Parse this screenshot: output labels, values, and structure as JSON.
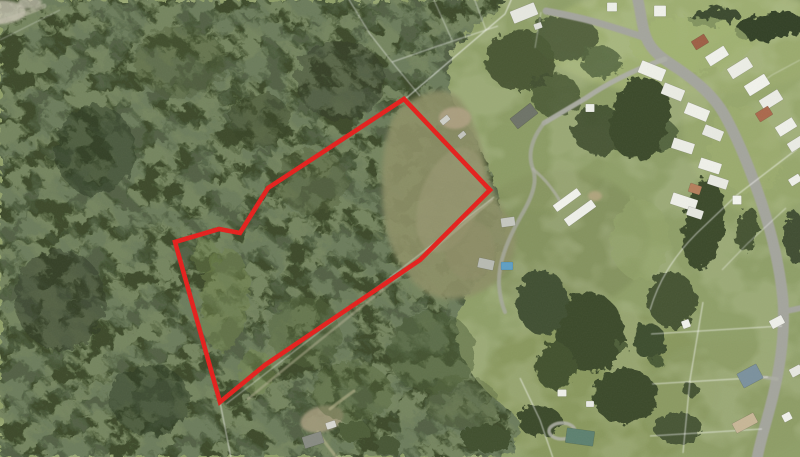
{
  "map": {
    "kind": "aerial-photo-with-parcel-overlay",
    "canvas": {
      "width": 800,
      "height": 457
    },
    "palette": {
      "field_base": "#8f9f68",
      "forest_base": "#3c4a2a",
      "forest_light_blotch": "#6b8449",
      "forest_dark_blotch": "#212e19",
      "clearing": "#8d8f66",
      "road": "#a4a59d",
      "cadastral_line": "#ffffff",
      "boundary_red": "#e51f1c"
    },
    "boundary_overlay": {
      "color": "#e51f1c",
      "stroke_width": 4.6,
      "closed": true,
      "points": [
        [
          404,
          99
        ],
        [
          490,
          190
        ],
        [
          420,
          260
        ],
        [
          265,
          365
        ],
        [
          220,
          402
        ],
        [
          175,
          242
        ],
        [
          219,
          229
        ],
        [
          240,
          233
        ],
        [
          268,
          188
        ]
      ]
    },
    "forest": {
      "clip": "M 0,0 L 505,0 C 496,16 470,30 454,50 C 446,66 446,86 453,100 C 463,120 479,143 489,168 C 495,185 500,206 504,224 C 507,247 490,268 471,290 C 457,307 452,326 459,349 C 469,376 489,397 513,413 C 524,425 518,443 504,457 L 0,457 Z",
      "base_fill": "#3c4a2a"
    },
    "clearing": {
      "path": "M 405,104 C 430,88 448,86 460,100 C 472,115 480,140 487,168 C 492,186 497,204 510,220 C 520,237 516,258 502,275 C 488,293 462,302 440,298 C 418,294 398,268 389,240 C 381,214 380,170 386,140 C 390,122 396,110 405,104 Z",
      "fill": "#8d8f66",
      "opacity": 0.9
    },
    "field_patches": [
      [
        690,
        40,
        150,
        55,
        0,
        "#a2b273",
        0.8
      ],
      [
        762,
        120,
        80,
        95,
        0,
        "#9aa96d",
        0.7
      ],
      [
        560,
        240,
        90,
        70,
        0,
        "#7e8c59",
        0.6
      ],
      [
        600,
        390,
        120,
        80,
        0,
        "#849158",
        0.55
      ],
      [
        730,
        400,
        90,
        60,
        0,
        "#8d9d66",
        0.6
      ],
      [
        545,
        150,
        60,
        60,
        0,
        "#8a9a62",
        0.6
      ]
    ],
    "dirt_patches": [
      [
        455,
        118,
        16,
        11,
        0,
        "#b0a184",
        0.85
      ],
      [
        595,
        196,
        7,
        5,
        0,
        "#b3a580",
        0.9
      ],
      [
        322,
        419,
        22,
        13,
        -15,
        "#a29a7c",
        0.9
      ],
      [
        0,
        12,
        26,
        12,
        0,
        "#c6c2b2",
        0.8
      ],
      [
        30,
        3,
        12,
        6,
        0,
        "#cac6b6",
        0.7
      ],
      [
        450,
        200,
        30,
        55,
        20,
        "#9a9873",
        0.6
      ],
      [
        470,
        250,
        25,
        30,
        0,
        "#8f8e68",
        0.6
      ]
    ],
    "vegetation": [
      [
        95,
        150,
        40,
        45,
        0,
        "#2c3722",
        0.5
      ],
      [
        60,
        300,
        45,
        50,
        0,
        "#2b3621",
        0.45
      ],
      [
        150,
        400,
        40,
        35,
        0,
        "#2e3923",
        0.5
      ],
      [
        340,
        80,
        45,
        40,
        0,
        "#2f3a24",
        0.4
      ],
      [
        260,
        120,
        30,
        28,
        0,
        "#313e26",
        0.45
      ],
      [
        225,
        300,
        24,
        52,
        4,
        "#6f8349",
        0.5
      ],
      [
        256,
        372,
        18,
        22,
        0,
        "#75894e",
        0.45
      ],
      [
        205,
        256,
        13,
        18,
        0,
        "#6d8148",
        0.4
      ],
      [
        305,
        332,
        36,
        36,
        0,
        "#55663c",
        0.45
      ],
      [
        352,
        392,
        40,
        30,
        0,
        "#51613a",
        0.4
      ],
      [
        432,
        352,
        44,
        40,
        0,
        "#4b5b35",
        0.5
      ],
      [
        462,
        402,
        36,
        26,
        0,
        "#52633c",
        0.4
      ],
      [
        312,
        182,
        36,
        32,
        0,
        "#4d5d38",
        0.4
      ],
      [
        180,
        62,
        46,
        36,
        0,
        "#495936",
        0.35
      ],
      [
        520,
        60,
        35,
        30,
        0,
        "#3c4a2c",
        0.85
      ],
      [
        555,
        95,
        25,
        22,
        0,
        "#42512f",
        0.8
      ],
      [
        600,
        130,
        28,
        25,
        0,
        "#3b492b",
        0.85
      ],
      [
        660,
        135,
        18,
        16,
        0,
        "#465534",
        0.8
      ],
      [
        640,
        118,
        30,
        42,
        12,
        "#3a482b",
        1
      ],
      [
        703,
        224,
        20,
        46,
        8,
        "#3a482b",
        1
      ],
      [
        672,
        300,
        24,
        28,
        0,
        "#445332",
        1
      ],
      [
        590,
        332,
        34,
        40,
        -10,
        "#3a482b",
        1
      ],
      [
        542,
        302,
        26,
        32,
        0,
        "#405031",
        1
      ],
      [
        625,
        396,
        32,
        28,
        0,
        "#3a482b",
        1
      ],
      [
        678,
        428,
        24,
        16,
        0,
        "#465534",
        1
      ],
      [
        555,
        366,
        20,
        24,
        0,
        "#42512f",
        1
      ],
      [
        650,
        342,
        16,
        18,
        0,
        "#3e4d2e",
        1
      ],
      [
        565,
        37,
        32,
        24,
        0,
        "#4a5a36",
        0.9
      ],
      [
        601,
        62,
        20,
        16,
        0,
        "#53643e",
        0.85
      ],
      [
        770,
        27,
        36,
        13,
        -8,
        "#334028",
        1
      ],
      [
        714,
        17,
        26,
        9,
        -6,
        "#3a4a2e",
        1
      ],
      [
        748,
        230,
        11,
        22,
        10,
        "#445332",
        1
      ],
      [
        795,
        238,
        10,
        26,
        0,
        "#3f4e30",
        1
      ],
      [
        540,
        421,
        22,
        15,
        0,
        "#3a482b",
        1
      ],
      [
        487,
        438,
        26,
        13,
        0,
        "#40502f",
        1
      ],
      [
        354,
        431,
        15,
        11,
        0,
        "#4d5d38",
        1
      ],
      [
        388,
        446,
        13,
        9,
        0,
        "#475736",
        1
      ],
      [
        692,
        391,
        8,
        7,
        0,
        "#445332",
        1
      ],
      [
        658,
        362,
        7,
        6,
        0,
        "#4a5a36",
        1
      ],
      [
        622,
        347,
        6,
        6,
        0,
        "#4d5d38",
        1
      ],
      [
        690,
        45,
        60,
        28,
        0,
        "#a3b374",
        0.7
      ],
      [
        745,
        150,
        35,
        45,
        -20,
        "#9fae70",
        0.6
      ],
      [
        640,
        240,
        30,
        40,
        0,
        "#95a56b",
        0.6
      ]
    ],
    "roads": [
      {
        "d": "M 637,-4 C 641,12 642,28 646,37 C 651,51 663,59 677,68 C 696,81 713,95 724,114 C 737,137 749,166 761,201 C 772,234 780,267 783,301 C 785,331 781,363 773,396 C 767,421 760,441 757,459",
        "s": "#a4a59d",
        "w": 11,
        "o": 1
      },
      {
        "d": "M 646,38 C 625,31 604,24 584,19 C 571,16 557,13 546,11",
        "s": "#a4a59d",
        "w": 7,
        "o": 1
      },
      {
        "d": "M 665,59 C 636,69 608,83 586,98 C 569,108 554,117 544,123",
        "s": "#adaea5",
        "w": 5,
        "o": 0.95
      },
      {
        "d": "M 544,123 C 530,141 528,156 533,169 C 538,183 531,199 521,216 C 507,241 498,263 499,285 C 500,297 502,305 505,312",
        "s": "#a8a99f",
        "w": 4,
        "o": 0.8
      },
      {
        "d": "M 533,169 C 546,180 556,193 562,205",
        "s": "#b0b1a7",
        "w": 3,
        "o": 0.7
      },
      {
        "d": "M 492,200 C 450,236 410,268 370,300 C 330,332 290,364 248,399",
        "s": "#b6b293",
        "w": 2.5,
        "o": 0.5
      },
      {
        "d": "M 782,312 L 801,308",
        "s": "#a4a59d",
        "w": 6,
        "o": 1
      },
      {
        "d": "M 777,379 L 762,377",
        "s": "#adaea5",
        "w": 3.5,
        "o": 0.85
      },
      {
        "d": "M 330,409 C 340,401 347,396 354,391",
        "s": "#b9b58f",
        "w": 3,
        "o": 0.6
      },
      {
        "d": "M 318,432 C 324,442 331,450 337,458",
        "s": "#b9b58f",
        "w": 3,
        "o": 0.6
      },
      {
        "d": "M -2,22 C 15,18 30,12 44,6",
        "s": "#c3bfae",
        "w": 5,
        "o": 0.5
      }
    ],
    "circular_driveway": {
      "cx": 562,
      "cy": 431,
      "rx": 13,
      "ry": 8,
      "s": "#b2b3a9",
      "w": 3.5,
      "o": 0.85
    },
    "cadastral_lines": [
      {
        "d": "M 512,-2 L 505,14 L 404,100",
        "o": 0.6
      },
      {
        "d": "M 494,197 L 226,404",
        "o": 0.4
      },
      {
        "d": "M 220,402 L 231,458",
        "o": 0.55
      },
      {
        "d": "M 348,-2 L 370,34 L 392,62 L 420,96",
        "o": 0.45
      },
      {
        "d": "M 392,62 L 435,47 L 498,26",
        "o": 0.45
      },
      {
        "d": "M 433,-2 L 452,40",
        "o": 0.4
      },
      {
        "d": "M 474,-2 L 486,30",
        "o": 0.4
      },
      {
        "d": "M 797,149 L 737,195 L 697,233 C 672,258 658,283 650,310",
        "o": 0.55
      },
      {
        "d": "M 703,302 L 690,380 L 683,453",
        "o": 0.55
      },
      {
        "d": "M 651,334 L 782,326",
        "o": 0.5
      },
      {
        "d": "M 652,384 L 768,377",
        "o": 0.5
      },
      {
        "d": "M 650,436 L 762,429",
        "o": 0.5
      },
      {
        "d": "M 520,378 L 540,420 L 553,458",
        "o": 0.55
      },
      {
        "d": "M 786,208 L 748,243 L 722,270",
        "o": 0.4
      },
      {
        "d": "M 0,40 L 60,10",
        "o": 0.3
      },
      {
        "d": "M 535,48 L 541,12",
        "o": 0.35
      },
      {
        "d": "M 800,60 L 772,75 L 748,92",
        "o": 0.3
      }
    ],
    "buildings": [
      [
        524,
        13,
        26,
        13,
        -22,
        "#e7e8e1"
      ],
      [
        538,
        26,
        8,
        6,
        -20,
        "#dfe0da"
      ],
      [
        612,
        7,
        10,
        9,
        0,
        "#eef0e9"
      ],
      [
        660,
        11,
        12,
        11,
        0,
        "#f1f2ec"
      ],
      [
        652,
        71,
        26,
        13,
        22,
        "#eff0e9"
      ],
      [
        673,
        92,
        22,
        12,
        22,
        "#ebece5"
      ],
      [
        697,
        112,
        24,
        12,
        22,
        "#f0f1ea"
      ],
      [
        713,
        133,
        20,
        11,
        22,
        "#e9eae3"
      ],
      [
        700,
        42,
        15,
        10,
        -32,
        "#9e5f45"
      ],
      [
        717,
        56,
        22,
        11,
        -32,
        "#f1f2ec"
      ],
      [
        740,
        68,
        24,
        12,
        -32,
        "#edeee7"
      ],
      [
        757,
        85,
        24,
        12,
        -32,
        "#f2f3ed"
      ],
      [
        771,
        100,
        22,
        12,
        -32,
        "#ecede6"
      ],
      [
        764,
        114,
        15,
        10,
        -32,
        "#ab684c"
      ],
      [
        786,
        127,
        20,
        11,
        -32,
        "#f0f1ea"
      ],
      [
        796,
        144,
        16,
        10,
        -32,
        "#ebece5"
      ],
      [
        683,
        146,
        22,
        11,
        18,
        "#edeee7"
      ],
      [
        710,
        166,
        22,
        11,
        18,
        "#f0f1ea"
      ],
      [
        718,
        182,
        20,
        10,
        18,
        "#eaebe4"
      ],
      [
        695,
        189,
        12,
        9,
        18,
        "#b57e5c"
      ],
      [
        684,
        202,
        26,
        12,
        18,
        "#eff0e9"
      ],
      [
        695,
        213,
        16,
        9,
        18,
        "#e7e8e1"
      ],
      [
        737,
        200,
        9,
        9,
        0,
        "#f3f4ee"
      ],
      [
        795,
        180,
        12,
        8,
        -32,
        "#eff0ea"
      ],
      [
        750,
        376,
        22,
        16,
        -28,
        "#7b919e"
      ],
      [
        745,
        423,
        24,
        11,
        -28,
        "#c8b797"
      ],
      [
        777,
        322,
        14,
        9,
        -28,
        "#eff0ea"
      ],
      [
        796,
        371,
        12,
        9,
        -28,
        "#e8e9e2"
      ],
      [
        787,
        417,
        9,
        8,
        -28,
        "#f1f2ec"
      ],
      [
        580,
        437,
        28,
        15,
        8,
        "#5d8170"
      ],
      [
        562,
        393,
        9,
        7,
        0,
        "#eff0e9"
      ],
      [
        590,
        404,
        8,
        6,
        0,
        "#ebece6"
      ],
      [
        524,
        116,
        26,
        13,
        -38,
        "#6e7368"
      ],
      [
        567,
        200,
        30,
        8,
        -36,
        "#f2f3ed"
      ],
      [
        580,
        213,
        34,
        9,
        -36,
        "#eff0ea"
      ],
      [
        508,
        222,
        14,
        9,
        -8,
        "#c6c8c1"
      ],
      [
        486,
        264,
        16,
        10,
        12,
        "#b8bbb3"
      ],
      [
        507,
        266,
        12,
        8,
        0,
        "#5f9fc4"
      ],
      [
        313,
        440,
        20,
        12,
        -18,
        "#878a82"
      ],
      [
        331,
        425,
        10,
        7,
        -18,
        "#d7d7d1"
      ],
      [
        590,
        108,
        9,
        8,
        0,
        "#eef0e9"
      ],
      [
        686,
        324,
        8,
        8,
        -20,
        "#f2f3ed"
      ],
      [
        445,
        120,
        10,
        6,
        -40,
        "#cfd0c9"
      ],
      [
        462,
        135,
        8,
        5,
        -40,
        "#c4c5be"
      ]
    ]
  }
}
